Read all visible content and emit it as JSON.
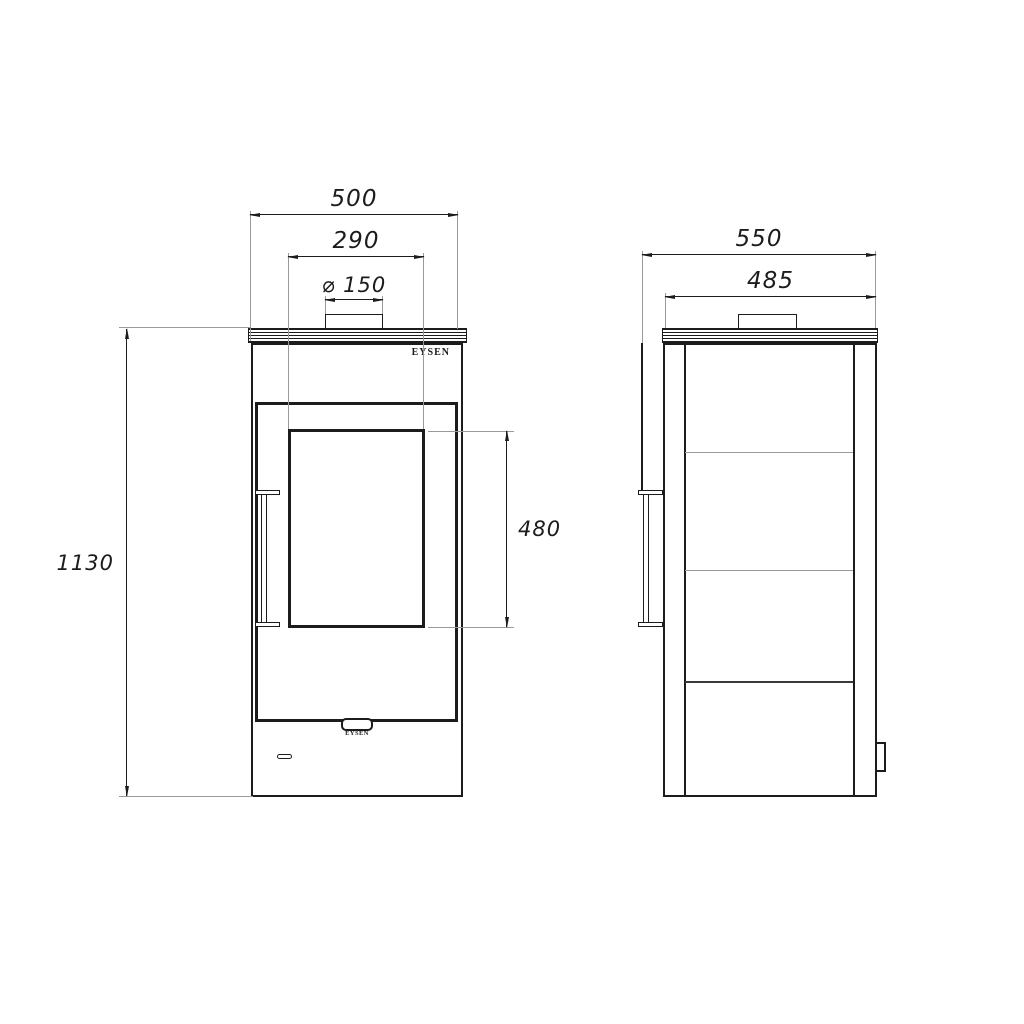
{
  "drawing_type": "technical-two-view-stove-drawing",
  "colors": {
    "ink": "#1c1c1c",
    "extension_line": "#9a9a9a",
    "paper": "#ffffff"
  },
  "views": {
    "front": {
      "brand_label": "EYSEN",
      "badge_label": "EYSEN",
      "dimensions": [
        {
          "id": "overall_width",
          "label": "500"
        },
        {
          "id": "flue_span_width",
          "label": "290"
        },
        {
          "id": "flue_diameter",
          "label": "⌀ 150"
        },
        {
          "id": "overall_height",
          "label": "1130"
        },
        {
          "id": "glass_height",
          "label": "480"
        }
      ]
    },
    "side": {
      "dimensions": [
        {
          "id": "overall_depth",
          "label": "550"
        },
        {
          "id": "body_depth",
          "label": "485"
        }
      ]
    }
  }
}
